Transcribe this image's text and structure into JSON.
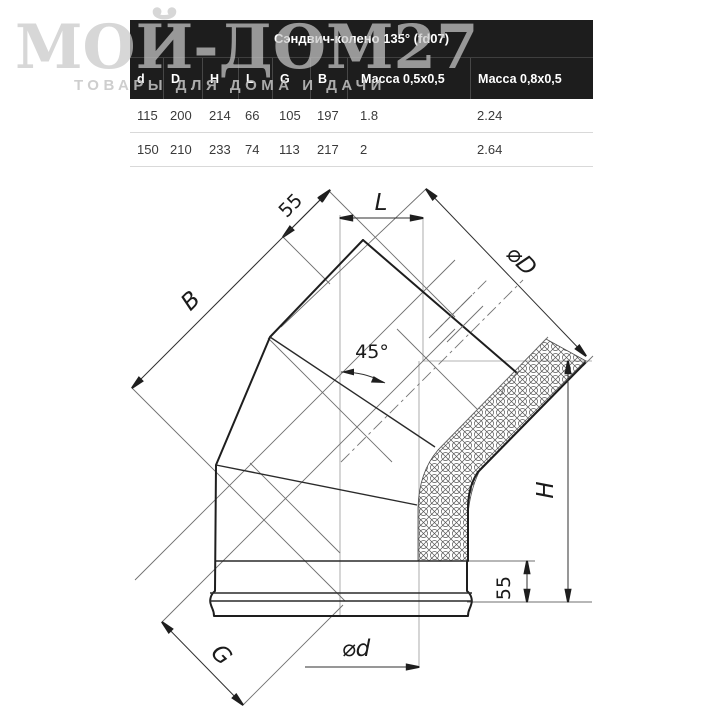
{
  "watermark": {
    "title": "МОЙ-ДОМ27",
    "subtitle": "ТОВАРЫ ДЛЯ ДОМА И ДАЧИ"
  },
  "table": {
    "title": "Сэндвич-колено 135° (fd07)",
    "columns": [
      "d",
      "D",
      "H",
      "L",
      "G",
      "B",
      "Масса 0,5x0,5",
      "Масса 0,8x0,5"
    ],
    "rows": [
      [
        "115",
        "200",
        "214",
        "66",
        "105",
        "197",
        "1.8",
        "2.24"
      ],
      [
        "150",
        "210",
        "233",
        "74",
        "113",
        "217",
        "2",
        "2.64"
      ]
    ]
  },
  "drawing": {
    "labels": {
      "socket_top": "55",
      "length_l": "L",
      "width_b": "B",
      "outer_diameter": "⌀D",
      "angle": "45°",
      "height_h": "H",
      "socket_bottom": "55",
      "width_g": "G",
      "inner_diameter": "⌀d"
    }
  },
  "colors": {
    "table_header_bg": "#1d1d1d",
    "table_header_text": "#ffffff",
    "table_row_text": "#3a3a3a",
    "table_row_border": "#d9d9d9",
    "watermark_gray": "#c8c8c8",
    "drawing_line": "#1e1e1e"
  }
}
